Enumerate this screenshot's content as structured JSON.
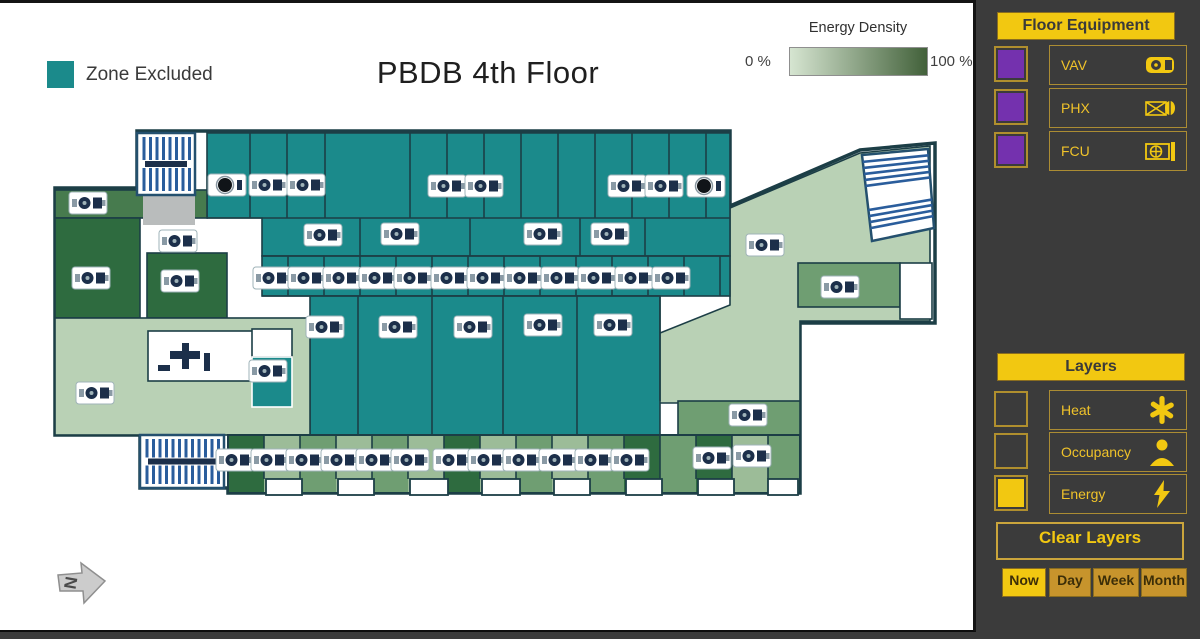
{
  "canvas": {
    "title": "PBDB 4th Floor",
    "zone_excluded_label": "Zone Excluded",
    "energy_legend": {
      "title": "Energy Density",
      "min_label": "0 %",
      "max_label": "100 %",
      "gradient_from": "#d6e5d1",
      "gradient_to": "#42613a"
    },
    "north_label": "N"
  },
  "colors": {
    "teal": "#1b8a8b",
    "light": "#b9d1b5",
    "light2": "#9cbc98",
    "mid": "#6f9e72",
    "green2": "#477b4e",
    "green3": "#2e6b3f",
    "gray": "#b9bcbc",
    "white": "#ffffff",
    "wall": "#1c3e46",
    "stair_blue": "#2a5d9c",
    "stair_border": "#24506e",
    "icon_navy": "#1c2f4a",
    "zone_excluded": "#1b8a8b",
    "accent_yellow": "#f2c811",
    "checkbox_purple": "#7431ae"
  },
  "sidebar": {
    "floor_equipment": {
      "header": "Floor Equipment",
      "items": [
        {
          "label": "VAV",
          "icon": "vav-icon",
          "checked": false
        },
        {
          "label": "PHX",
          "icon": "phx-icon",
          "checked": false
        },
        {
          "label": "FCU",
          "icon": "fcu-icon",
          "checked": false
        }
      ]
    },
    "layers": {
      "header": "Layers",
      "items": [
        {
          "label": "Heat",
          "icon": "heat-icon",
          "checked": false
        },
        {
          "label": "Occupancy",
          "icon": "occupancy-icon",
          "checked": false
        },
        {
          "label": "Energy",
          "icon": "energy-icon",
          "checked": true
        }
      ]
    },
    "clear_layers_label": "Clear Layers",
    "time_buttons": [
      {
        "label": "Now",
        "active": true
      },
      {
        "label": "Day",
        "active": false
      },
      {
        "label": "Week",
        "active": false
      },
      {
        "label": "Month",
        "active": false
      }
    ]
  },
  "floorplan": {
    "outline": "M137,128 H730 V203 L860,147 L935,140 V320 H800 V490 H228 V485 H140 V432 H55 V185 H137 Z",
    "regions": [
      {
        "t": "path",
        "d": "M730,205 L860,150 L930,143 L930,318 L800,318 L800,400 L655,400 L655,332 L730,302 Z",
        "f": "light"
      },
      {
        "t": "path",
        "d": "M207,130 H730 V253 H262 V215 H207 Z",
        "f": "teal"
      },
      {
        "t": "rect",
        "x": 262,
        "y": 253,
        "w": 468,
        "h": 40,
        "f": "teal"
      },
      {
        "t": "rect",
        "x": 310,
        "y": 293,
        "w": 350,
        "h": 139,
        "f": "teal"
      },
      {
        "t": "rect",
        "x": 55,
        "y": 187,
        "w": 152,
        "h": 28,
        "f": "green2"
      },
      {
        "t": "rect",
        "x": 55,
        "y": 215,
        "w": 85,
        "h": 100,
        "f": "green3"
      },
      {
        "t": "rect",
        "x": 147,
        "y": 250,
        "w": 80,
        "h": 65,
        "f": "green3"
      },
      {
        "t": "rect",
        "x": 143,
        "y": 192,
        "w": 52,
        "h": 30,
        "f": "gray",
        "ns": 1
      },
      {
        "t": "rect",
        "x": 55,
        "y": 315,
        "w": 255,
        "h": 117,
        "f": "light"
      },
      {
        "t": "rect",
        "x": 148,
        "y": 328,
        "w": 142,
        "h": 50,
        "f": "white"
      },
      {
        "t": "rect",
        "x": 252,
        "y": 326,
        "w": 40,
        "h": 28,
        "f": "white"
      },
      {
        "t": "rect",
        "x": 252,
        "y": 354,
        "w": 40,
        "h": 50,
        "f": "teal",
        "ws": 1
      },
      {
        "t": "rect",
        "x": 798,
        "y": 260,
        "w": 102,
        "h": 44,
        "f": "mid"
      },
      {
        "t": "rect",
        "x": 900,
        "y": 260,
        "w": 32,
        "h": 56,
        "f": "white"
      },
      {
        "t": "rect",
        "x": 678,
        "y": 398,
        "w": 122,
        "h": 34,
        "f": "mid"
      }
    ],
    "bottom_band": {
      "x": 228,
      "y": 432,
      "w": 572,
      "h": 58,
      "shades": [
        "green3",
        "light2",
        "mid",
        "light2",
        "mid",
        "light2",
        "green3",
        "light2",
        "mid",
        "light2",
        "mid",
        "green3",
        "mid",
        "green3",
        "light2",
        "mid"
      ],
      "seg_w": 36,
      "dividers": {
        "x0": 264,
        "x1": 768,
        "step": 36,
        "y0": 432,
        "y1": 476
      },
      "notches": [
        [
          266,
          36
        ],
        [
          338,
          36
        ],
        [
          410,
          38
        ],
        [
          482,
          38
        ],
        [
          554,
          36
        ],
        [
          626,
          36
        ],
        [
          698,
          36
        ],
        [
          768,
          30
        ]
      ],
      "notch_y": 476,
      "notch_h": 16
    },
    "walls": [
      [
        207,
        215,
        730,
        215
      ],
      [
        262,
        253,
        730,
        253
      ],
      [
        262,
        293,
        660,
        293
      ],
      [
        250,
        130,
        250,
        215
      ],
      [
        287,
        130,
        287,
        215
      ],
      [
        325,
        130,
        325,
        215
      ],
      [
        410,
        130,
        410,
        215
      ],
      [
        447,
        130,
        447,
        215
      ],
      [
        484,
        130,
        484,
        215
      ],
      [
        521,
        130,
        521,
        215
      ],
      [
        558,
        130,
        558,
        215
      ],
      [
        595,
        130,
        595,
        215
      ],
      [
        632,
        130,
        632,
        215
      ],
      [
        669,
        130,
        669,
        215
      ],
      [
        706,
        130,
        706,
        215
      ],
      [
        360,
        215,
        360,
        253
      ],
      [
        470,
        215,
        470,
        253
      ],
      [
        580,
        215,
        580,
        253
      ],
      [
        645,
        215,
        645,
        253
      ],
      [
        288,
        253,
        288,
        293
      ],
      [
        324,
        253,
        324,
        293
      ],
      [
        360,
        253,
        360,
        293
      ],
      [
        396,
        253,
        396,
        293
      ],
      [
        432,
        253,
        432,
        293
      ],
      [
        468,
        253,
        468,
        293
      ],
      [
        504,
        253,
        504,
        293
      ],
      [
        540,
        253,
        540,
        293
      ],
      [
        576,
        253,
        576,
        293
      ],
      [
        612,
        253,
        612,
        293
      ],
      [
        648,
        253,
        648,
        293
      ],
      [
        684,
        253,
        684,
        293
      ],
      [
        720,
        253,
        720,
        293
      ],
      [
        358,
        293,
        358,
        432
      ],
      [
        432,
        293,
        432,
        432
      ],
      [
        503,
        293,
        503,
        432
      ],
      [
        577,
        293,
        577,
        432
      ],
      [
        660,
        293,
        660,
        398
      ]
    ],
    "stairs_v": [
      {
        "x": 137,
        "y": 130,
        "w": 58,
        "h": 62
      },
      {
        "x": 140,
        "y": 432,
        "w": 84,
        "h": 53
      }
    ],
    "stairs_quad": {
      "p": [
        [
          862,
          152
        ],
        [
          928,
          146
        ],
        [
          934,
          225
        ],
        [
          872,
          238
        ]
      ]
    },
    "furniture": [
      [
        170,
        348,
        30,
        8
      ],
      [
        182,
        340,
        7,
        26
      ],
      [
        158,
        362,
        12,
        6
      ],
      [
        204,
        350,
        6,
        18
      ]
    ],
    "icons": [
      [
        227,
        182,
        2
      ],
      [
        268,
        182,
        1
      ],
      [
        306,
        182,
        1
      ],
      [
        447,
        183,
        1
      ],
      [
        484,
        183,
        1
      ],
      [
        627,
        183,
        1
      ],
      [
        664,
        183,
        1
      ],
      [
        706,
        183,
        2
      ],
      [
        88,
        200,
        1
      ],
      [
        178,
        238,
        1
      ],
      [
        323,
        232,
        1
      ],
      [
        400,
        231,
        1
      ],
      [
        543,
        231,
        1
      ],
      [
        610,
        231,
        1
      ],
      [
        765,
        242,
        1
      ],
      [
        91,
        275,
        1
      ],
      [
        180,
        278,
        1
      ],
      [
        272,
        275,
        1
      ],
      [
        307,
        275,
        1
      ],
      [
        342,
        275,
        1
      ],
      [
        378,
        275,
        1
      ],
      [
        413,
        275,
        1
      ],
      [
        450,
        275,
        1
      ],
      [
        486,
        275,
        1
      ],
      [
        523,
        275,
        1
      ],
      [
        560,
        275,
        1
      ],
      [
        597,
        275,
        1
      ],
      [
        634,
        275,
        1
      ],
      [
        671,
        275,
        1
      ],
      [
        840,
        284,
        1
      ],
      [
        325,
        324,
        1
      ],
      [
        398,
        324,
        1
      ],
      [
        473,
        324,
        1
      ],
      [
        543,
        322,
        1
      ],
      [
        613,
        322,
        1
      ],
      [
        268,
        368,
        1
      ],
      [
        95,
        390,
        1
      ],
      [
        748,
        412,
        1
      ],
      [
        235,
        457,
        1
      ],
      [
        270,
        457,
        1
      ],
      [
        305,
        457,
        1
      ],
      [
        340,
        457,
        1
      ],
      [
        375,
        457,
        1
      ],
      [
        410,
        457,
        1
      ],
      [
        452,
        457,
        1
      ],
      [
        487,
        457,
        1
      ],
      [
        522,
        457,
        1
      ],
      [
        558,
        457,
        1
      ],
      [
        594,
        457,
        1
      ],
      [
        630,
        457,
        1
      ],
      [
        712,
        455,
        1
      ],
      [
        752,
        453,
        1
      ]
    ],
    "north_arrow": {
      "x": 58,
      "y": 558
    }
  }
}
